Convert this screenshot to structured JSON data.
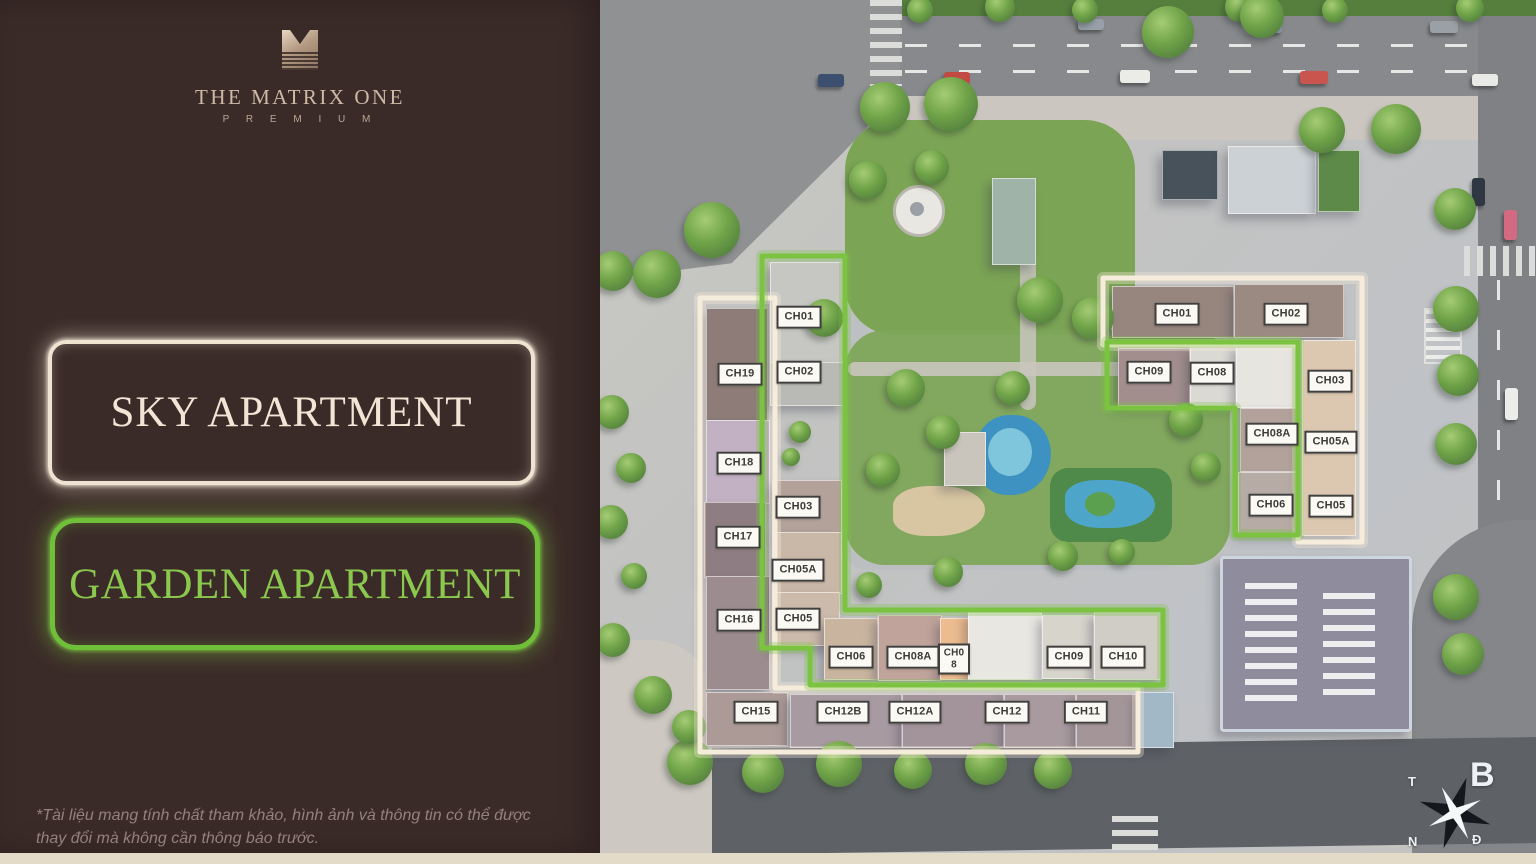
{
  "panel": {
    "brand": {
      "title": "THE MATRIX ONE",
      "subtitle": "P R E M I U M"
    },
    "sky_label": "SKY APARTMENT",
    "garden_label": "GARDEN APARTMENT",
    "disclaimer": "*Tài liệu mang tính chất tham khảo, hình ảnh và thông tin có thể được thay đổi mà không cần thông báo trước."
  },
  "legend": {
    "sky_outline_color": "#f5ecdb",
    "garden_outline_color": "#7cc342",
    "panel_color": "#3b2b28"
  },
  "compass": {
    "north": "B",
    "west": "T",
    "south": "N",
    "east": "Đ"
  },
  "map": {
    "units": [
      {
        "text": "CH19",
        "x": 740,
        "y": 374,
        "group": "sky-left"
      },
      {
        "text": "CH18",
        "x": 739,
        "y": 463,
        "group": "sky-left"
      },
      {
        "text": "CH17",
        "x": 738,
        "y": 537,
        "group": "sky-left"
      },
      {
        "text": "CH16",
        "x": 739,
        "y": 620,
        "group": "sky-left"
      },
      {
        "text": "CH15",
        "x": 756,
        "y": 712,
        "group": "sky-left"
      },
      {
        "text": "CH12B",
        "x": 843,
        "y": 712,
        "group": "sky-left"
      },
      {
        "text": "CH12A",
        "x": 915,
        "y": 712,
        "group": "sky-left"
      },
      {
        "text": "CH12",
        "x": 1007,
        "y": 712,
        "group": "sky-left"
      },
      {
        "text": "CH11",
        "x": 1086,
        "y": 712,
        "group": "sky-left"
      },
      {
        "text": "CH01",
        "x": 799,
        "y": 317,
        "group": "garden-left"
      },
      {
        "text": "CH02",
        "x": 799,
        "y": 372,
        "group": "garden-left"
      },
      {
        "text": "CH03",
        "x": 798,
        "y": 507,
        "group": "garden-left"
      },
      {
        "text": "CH05A",
        "x": 798,
        "y": 570,
        "group": "garden-left"
      },
      {
        "text": "CH05",
        "x": 798,
        "y": 619,
        "group": "garden-left"
      },
      {
        "text": "CH06",
        "x": 851,
        "y": 657,
        "group": "garden-row"
      },
      {
        "text": "CH08A",
        "x": 913,
        "y": 657,
        "group": "garden-row"
      },
      {
        "text": "CH08",
        "x": 954,
        "y": 659,
        "group": "garden-row",
        "stack": true
      },
      {
        "text": "CH09",
        "x": 1069,
        "y": 657,
        "group": "garden-row"
      },
      {
        "text": "CH10",
        "x": 1123,
        "y": 657,
        "group": "garden-row"
      },
      {
        "text": "CH01",
        "x": 1177,
        "y": 314,
        "group": "sky-right"
      },
      {
        "text": "CH02",
        "x": 1286,
        "y": 314,
        "group": "sky-right"
      },
      {
        "text": "CH03",
        "x": 1330,
        "y": 381,
        "group": "sky-right"
      },
      {
        "text": "CH05A",
        "x": 1331,
        "y": 442,
        "group": "sky-right"
      },
      {
        "text": "CH05",
        "x": 1331,
        "y": 506,
        "group": "sky-right"
      },
      {
        "text": "CH09",
        "x": 1149,
        "y": 372,
        "group": "garden-right"
      },
      {
        "text": "CH08",
        "x": 1212,
        "y": 373,
        "group": "garden-right"
      },
      {
        "text": "CH08A",
        "x": 1272,
        "y": 434,
        "group": "garden-right"
      },
      {
        "text": "CH06",
        "x": 1271,
        "y": 505,
        "group": "garden-right"
      }
    ],
    "buildings": [
      {
        "x": 706,
        "y": 308,
        "w": 60,
        "h": 112,
        "c": "#8d7c78"
      },
      {
        "x": 706,
        "y": 420,
        "w": 62,
        "h": 82,
        "c": "#c2b1c2"
      },
      {
        "x": 704,
        "y": 502,
        "w": 60,
        "h": 74,
        "c": "#8e7d82"
      },
      {
        "x": 706,
        "y": 576,
        "w": 62,
        "h": 112,
        "c": "#9c8b8f"
      },
      {
        "x": 770,
        "y": 262,
        "w": 72,
        "h": 100,
        "c": "#c6c6c2"
      },
      {
        "x": 770,
        "y": 362,
        "w": 72,
        "h": 42,
        "c": "#b9b9b5"
      },
      {
        "x": 772,
        "y": 480,
        "w": 68,
        "h": 52,
        "c": "#b2a29a"
      },
      {
        "x": 772,
        "y": 532,
        "w": 68,
        "h": 60,
        "c": "#c9b7a8"
      },
      {
        "x": 772,
        "y": 592,
        "w": 66,
        "h": 52,
        "c": "#ccbaab"
      },
      {
        "x": 824,
        "y": 618,
        "w": 52,
        "h": 60,
        "c": "#c9b59f"
      },
      {
        "x": 878,
        "y": 615,
        "w": 62,
        "h": 64,
        "c": "#c0a49b"
      },
      {
        "x": 940,
        "y": 618,
        "w": 28,
        "h": 60,
        "c": "#ecbc90"
      },
      {
        "x": 968,
        "y": 612,
        "w": 72,
        "h": 66,
        "c": "#e9e7e2"
      },
      {
        "x": 1042,
        "y": 615,
        "w": 50,
        "h": 62,
        "c": "#d7d4cc"
      },
      {
        "x": 1094,
        "y": 612,
        "w": 66,
        "h": 66,
        "c": "#d0cdc6"
      },
      {
        "x": 706,
        "y": 692,
        "w": 80,
        "h": 52,
        "c": "#ab9a96"
      },
      {
        "x": 790,
        "y": 694,
        "w": 110,
        "h": 52,
        "c": "#a79aa0"
      },
      {
        "x": 902,
        "y": 694,
        "w": 100,
        "h": 52,
        "c": "#a2949a"
      },
      {
        "x": 1004,
        "y": 694,
        "w": 70,
        "h": 52,
        "c": "#a89a9e"
      },
      {
        "x": 1076,
        "y": 694,
        "w": 60,
        "h": 52,
        "c": "#a39598"
      },
      {
        "x": 1138,
        "y": 692,
        "w": 34,
        "h": 54,
        "c": "#a3b8c6"
      },
      {
        "x": 1112,
        "y": 286,
        "w": 120,
        "h": 50,
        "c": "#97867e"
      },
      {
        "x": 1234,
        "y": 284,
        "w": 108,
        "h": 52,
        "c": "#9b8a82"
      },
      {
        "x": 1118,
        "y": 348,
        "w": 70,
        "h": 56,
        "c": "#a28f8d"
      },
      {
        "x": 1190,
        "y": 346,
        "w": 44,
        "h": 58,
        "c": "#dbd9d4"
      },
      {
        "x": 1236,
        "y": 344,
        "w": 62,
        "h": 62,
        "c": "#e7e5e0"
      },
      {
        "x": 1240,
        "y": 408,
        "w": 58,
        "h": 62,
        "c": "#b3a29c"
      },
      {
        "x": 1238,
        "y": 472,
        "w": 60,
        "h": 60,
        "c": "#b7aba5"
      },
      {
        "x": 1302,
        "y": 340,
        "w": 52,
        "h": 194,
        "c": "#dcc8b0"
      },
      {
        "x": 1162,
        "y": 150,
        "w": 54,
        "h": 48,
        "c": "#47525b"
      },
      {
        "x": 1228,
        "y": 146,
        "w": 86,
        "h": 66,
        "c": "#ccd1d5"
      },
      {
        "x": 1318,
        "y": 150,
        "w": 40,
        "h": 60,
        "c": "#5d8a48"
      },
      {
        "x": 992,
        "y": 178,
        "w": 42,
        "h": 85,
        "c": "#9fb3a8"
      },
      {
        "x": 944,
        "y": 432,
        "w": 40,
        "h": 52,
        "c": "#cac5bc"
      },
      {
        "x": 1220,
        "y": 556,
        "w": 186,
        "h": 170,
        "c": "#8f8c9d",
        "cls": "amenity"
      }
    ],
    "trees": [
      [
        920,
        10,
        26
      ],
      [
        1000,
        7,
        30
      ],
      [
        1085,
        10,
        26
      ],
      [
        1240,
        7,
        30
      ],
      [
        1335,
        10,
        26
      ],
      [
        1470,
        8,
        28
      ],
      [
        1168,
        32,
        52
      ],
      [
        1262,
        16,
        44
      ],
      [
        712,
        230,
        56
      ],
      [
        657,
        274,
        48
      ],
      [
        613,
        271,
        40
      ],
      [
        885,
        107,
        50
      ],
      [
        951,
        104,
        54
      ],
      [
        868,
        180,
        38
      ],
      [
        932,
        167,
        34
      ],
      [
        1040,
        300,
        46
      ],
      [
        1093,
        318,
        42
      ],
      [
        824,
        318,
        38
      ],
      [
        1322,
        130,
        46
      ],
      [
        1396,
        129,
        50
      ],
      [
        1455,
        209,
        42
      ],
      [
        1456,
        309,
        46
      ],
      [
        1458,
        375,
        42
      ],
      [
        1456,
        444,
        42
      ],
      [
        906,
        388,
        38
      ],
      [
        943,
        432,
        34
      ],
      [
        883,
        470,
        34
      ],
      [
        1013,
        388,
        34
      ],
      [
        1186,
        420,
        34
      ],
      [
        1206,
        467,
        30
      ],
      [
        1063,
        556,
        30
      ],
      [
        1122,
        552,
        26
      ],
      [
        948,
        572,
        30
      ],
      [
        869,
        585,
        26
      ],
      [
        800,
        432,
        22
      ],
      [
        791,
        457,
        18
      ],
      [
        690,
        762,
        46
      ],
      [
        763,
        772,
        42
      ],
      [
        839,
        764,
        46
      ],
      [
        913,
        770,
        38
      ],
      [
        986,
        764,
        42
      ],
      [
        1053,
        770,
        38
      ],
      [
        1456,
        597,
        46
      ],
      [
        1463,
        654,
        42
      ],
      [
        612,
        412,
        34
      ],
      [
        631,
        468,
        30
      ],
      [
        611,
        522,
        34
      ],
      [
        634,
        576,
        26
      ],
      [
        613,
        640,
        34
      ],
      [
        653,
        695,
        38
      ],
      [
        689,
        727,
        34
      ]
    ],
    "cars": [
      [
        818,
        74,
        26,
        13,
        "#3d4f6e"
      ],
      [
        944,
        72,
        26,
        12,
        "#c24a42"
      ],
      [
        1120,
        70,
        30,
        13,
        "#ebebe8"
      ],
      [
        1300,
        71,
        28,
        13,
        "#c9554e"
      ],
      [
        1472,
        74,
        26,
        12,
        "#e9e9e6"
      ],
      [
        1078,
        19,
        26,
        11,
        "#98a0aa"
      ],
      [
        1252,
        21,
        30,
        12,
        "#8b97ad"
      ],
      [
        1430,
        21,
        28,
        12,
        "#9aa0a6"
      ],
      [
        1504,
        210,
        13,
        30,
        "#d36a82"
      ],
      [
        1472,
        178,
        13,
        28,
        "#2f3743"
      ],
      [
        1505,
        388,
        13,
        32,
        "#ececea"
      ]
    ]
  }
}
